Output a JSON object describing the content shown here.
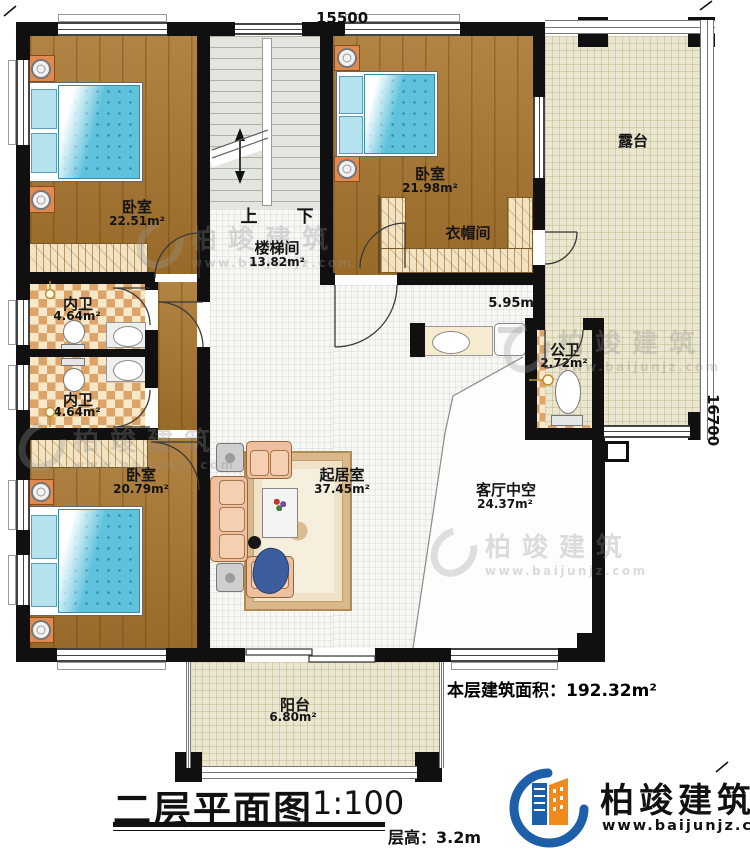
{
  "dimensions": {
    "top": "15500",
    "right": "16700"
  },
  "rooms": {
    "bedroom_tl": {
      "name": "卧室",
      "area": "22.51m²"
    },
    "bedroom_tr": {
      "name": "卧室",
      "area": "21.98m²"
    },
    "bedroom_bl": {
      "name": "卧室",
      "area": "20.79m²"
    },
    "stairwell": {
      "name": "楼梯间",
      "area": "13.82m²",
      "up_label": "上",
      "down_label": "下"
    },
    "cloakroom": {
      "name": "衣帽间"
    },
    "terrace": {
      "name": "露台"
    },
    "inner_bath_1": {
      "name": "内卫",
      "area": "4.64m²"
    },
    "inner_bath_2": {
      "name": "内卫",
      "area": "4.64m²"
    },
    "hall": {
      "name": "起居室",
      "area": "37.45m²"
    },
    "corridor": {
      "area": "5.95m²"
    },
    "public_bath": {
      "name": "公卫",
      "area": "2.72m²"
    },
    "living_void": {
      "name": "客厅中空",
      "area": "24.37m²"
    },
    "balcony": {
      "name": "阳台",
      "area": "6.80m²"
    }
  },
  "annotations": {
    "floor_area": "本层建筑面积：192.32m²",
    "plan_title": "二层平面图",
    "plan_scale": "1:100",
    "floor_height": "层高：3.2m"
  },
  "branding": {
    "company": "柏竣建筑",
    "website": "www.baijunjz.com"
  },
  "colors": {
    "wall": "#101010",
    "wood_floor": "#a9762e",
    "tile_floor": "#f7f7f4",
    "terrace_floor": "#eae6cf",
    "bath_tile": "#dca468",
    "bed": "#5ec2dc",
    "sofa": "#eec0a0",
    "logo_blue": "#1d5fa9",
    "logo_orange": "#f18a1d"
  }
}
